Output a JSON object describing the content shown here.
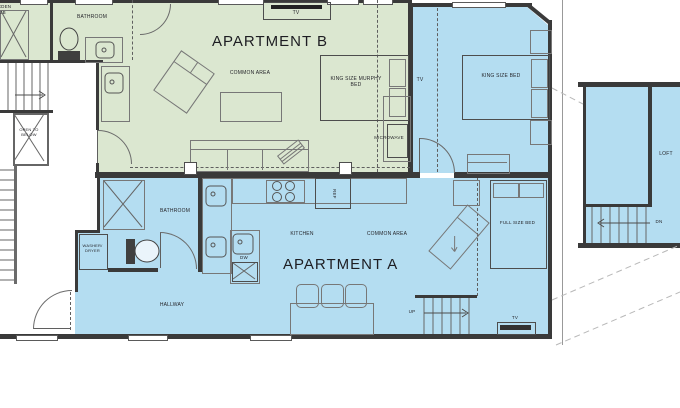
{
  "plan": {
    "colors": {
      "apartment_b_fill": "#dbe7d0",
      "apartment_a_fill": "#b4ddf1",
      "wall": "#3a3a3a"
    },
    "apartment_b": {
      "title": "APARTMENT B",
      "bathroom": "BATHROOM",
      "garden_tub": "GARDEN TUB",
      "common_area": "COMMON AREA",
      "murphy_bed": "KING SIZE MURPHY BED",
      "tv": "TV",
      "microwave": "MICROWAVE"
    },
    "bedroom": {
      "king_bed": "KING SIZE BED",
      "tv": "TV"
    },
    "apartment_a": {
      "title": "APARTMENT A",
      "bathroom": "BATHROOM",
      "kitchen": "KITCHEN",
      "common_area": "COMMON AREA",
      "hallway": "HALLWAY",
      "washer_dryer": "WASHER/ DRYER",
      "dishwasher": "DW",
      "refrigerator": "REF",
      "full_bed": "FULL SIZE BED",
      "stairs_up": "UP",
      "tv": "TV"
    },
    "loft": {
      "label": "LOFT",
      "stairs_down": "DN"
    },
    "stairwell": {
      "open_to_below": "OPEN TO BELOW"
    }
  }
}
